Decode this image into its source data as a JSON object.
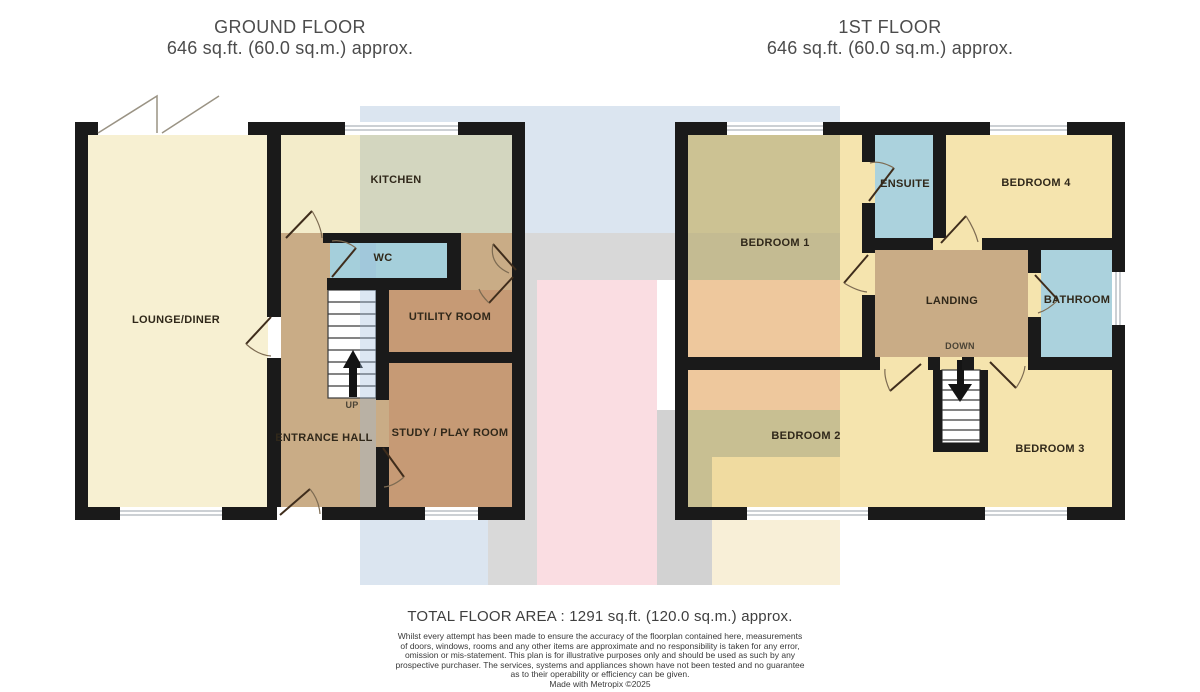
{
  "headers": {
    "ground": {
      "title": "GROUND FLOOR",
      "subtitle": "646 sq.ft. (60.0 sq.m.) approx."
    },
    "first": {
      "title": "1ST FLOOR",
      "subtitle": "646 sq.ft. (60.0 sq.m.) approx."
    }
  },
  "floors": {
    "ground": {
      "lounge": "LOUNGE/DINER",
      "kitchen": "KITCHEN",
      "wc": "WC",
      "utility": "UTILITY ROOM",
      "hall": "ENTRANCE HALL",
      "study": "STUDY / PLAY ROOM",
      "stair": "UP"
    },
    "first": {
      "bedroom1": "BEDROOM 1",
      "ensuite": "ENSUITE",
      "bedroom4": "BEDROOM 4",
      "landing": "LANDING",
      "bathroom": "BATHROOM",
      "stair": "DOWN",
      "bedroom2": "BEDROOM 2",
      "bedroom3": "BEDROOM 3"
    }
  },
  "footer": {
    "total": "TOTAL FLOOR AREA : 1291 sq.ft. (120.0 sq.m.) approx.",
    "disclaimer_lines": [
      "Whilst every attempt has been made to ensure the accuracy of the floorplan contained here, measurements",
      "of doors, windows, rooms and any other items are approximate and no responsibility is taken for any error,",
      "omission or mis-statement. This plan is for illustrative purposes only and should be used as such by any",
      "prospective purchaser. The services, systems and appliances shown have not been tested and no guarantee",
      "as to their operability or efficiency can be given."
    ],
    "credit": "Made with Metropix ©2025"
  },
  "colors": {
    "wall": "#1a1a1a",
    "lounge_cream": "#f7f0d2",
    "kitchen_pale": "#f3ecca",
    "kitchen_sage": "#d3d6bf",
    "hall_landing_tan": "#c9ac86",
    "wet_room_blue": "#abd2dd",
    "utility_study_brown": "#c69a75",
    "bedroom_yellow": "#f5e4ae",
    "bedroom_olive": "#ccc293",
    "bedroom_orange": "#eec89d",
    "bedroom2_deep_yellow": "#f0dba0",
    "band_blue": "#dbe5f0",
    "band_gray": "#d8d8d8",
    "band_pink": "#fadde2",
    "band_cream": "#f8efd7"
  }
}
